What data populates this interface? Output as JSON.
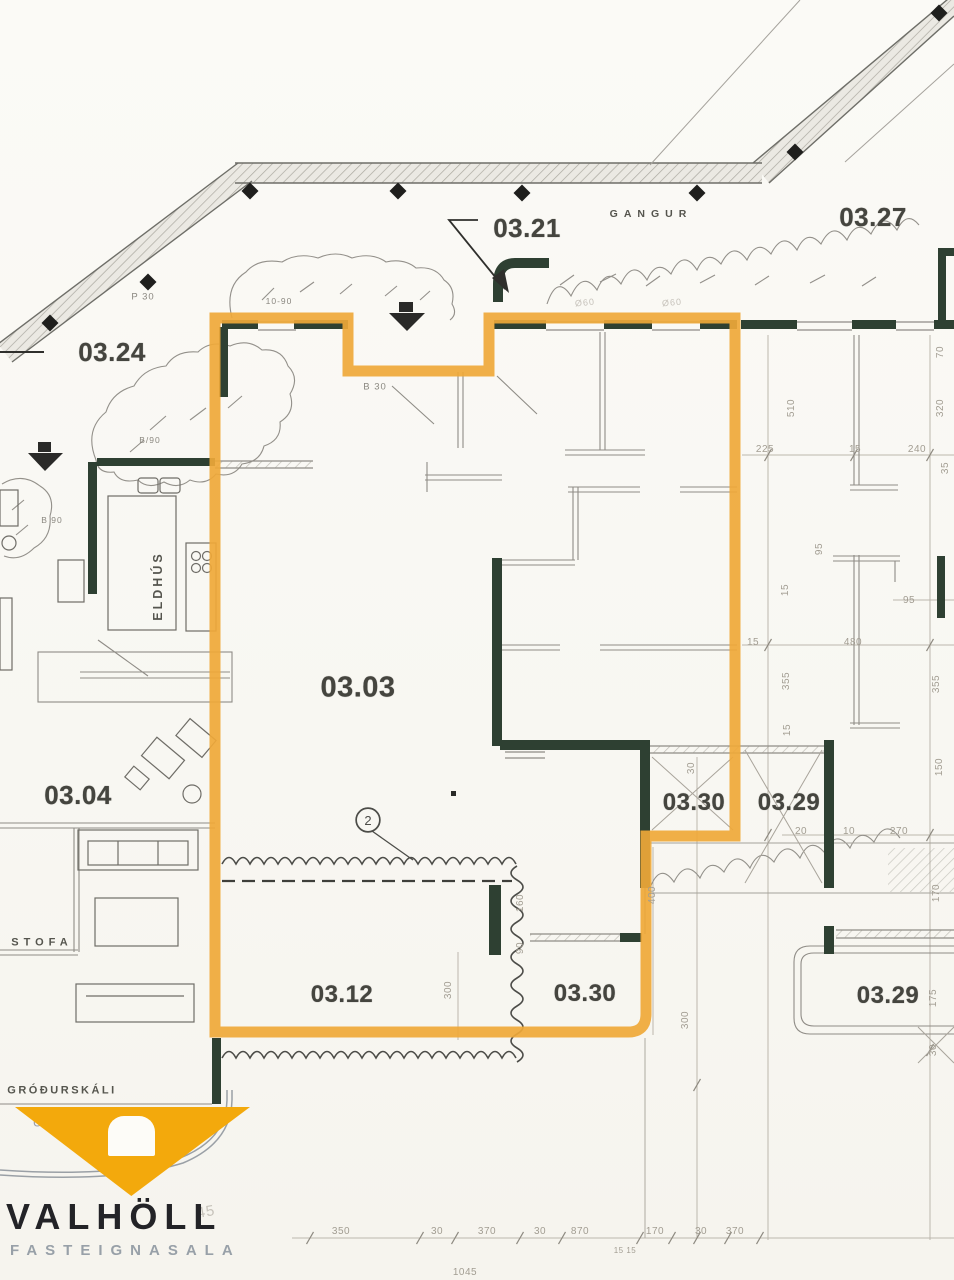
{
  "colors": {
    "paper": "#f9f8f4",
    "highlight_outline": "#efa838",
    "wall_green": "#2e4032",
    "thin_line": "#8f8c86",
    "dim_text": "#a29d92",
    "label_text": "#45453f",
    "logo_yellow": "#f3a90c",
    "logo_text": "#232327",
    "logo_subtext": "#98a0a8"
  },
  "plan": {
    "room_labels": [
      {
        "name": "room-label-03-21",
        "text": "03.21",
        "x": 527,
        "y": 228
      },
      {
        "name": "room-label-03-27",
        "text": "03.27",
        "x": 873,
        "y": 217
      },
      {
        "name": "room-label-03-24",
        "text": "03.24",
        "x": 112,
        "y": 352
      },
      {
        "name": "room-label-03-03",
        "text": "03.03",
        "x": 358,
        "y": 688,
        "size": 29
      },
      {
        "name": "room-label-03-04",
        "text": "03.04",
        "x": 78,
        "y": 795
      },
      {
        "name": "room-label-03-30-mid",
        "text": "03.30",
        "x": 694,
        "y": 803,
        "size": 24
      },
      {
        "name": "room-label-03-29-mid",
        "text": "03.29",
        "x": 789,
        "y": 803,
        "size": 24
      },
      {
        "name": "room-label-03-12",
        "text": "03.12",
        "x": 342,
        "y": 995,
        "size": 24
      },
      {
        "name": "room-label-03-30-bottom",
        "text": "03.30",
        "x": 585,
        "y": 994,
        "size": 24
      },
      {
        "name": "room-label-03-29-bottom",
        "text": "03.29",
        "x": 888,
        "y": 996,
        "size": 24
      }
    ],
    "area_labels": [
      {
        "name": "area-label-gangur",
        "text": "GANGUR",
        "x": 651,
        "y": 214,
        "size": 10.5,
        "ls": 6
      },
      {
        "name": "area-label-stofa",
        "text": "STOFA",
        "x": 42,
        "y": 943,
        "size": 11,
        "ls": 5
      },
      {
        "name": "area-label-eldhus",
        "text": "ELDHÚS",
        "x": 158,
        "y": 586,
        "size": 12.5,
        "ls": 3,
        "rot": -90
      },
      {
        "name": "area-label-grodurskali",
        "text": "GRÓÐURSKÁLI",
        "x": 62,
        "y": 1091,
        "size": 11,
        "ls": 2.5
      }
    ],
    "small_labels": [
      {
        "name": "note-p30",
        "text": "P 30",
        "x": 143,
        "y": 297
      },
      {
        "name": "note-b30",
        "text": "B 30",
        "x": 375,
        "y": 387
      },
      {
        "name": "note-10-90",
        "text": "10-90",
        "x": 279,
        "y": 301,
        "size": 8.5
      },
      {
        "name": "note-b90-upper",
        "text": "B/90",
        "x": 150,
        "y": 440,
        "size": 8.5
      },
      {
        "name": "note-b90-lower",
        "text": "B 90",
        "x": 52,
        "y": 520,
        "size": 8.5
      },
      {
        "name": "note-o60-a",
        "text": "Ø60",
        "x": 585,
        "y": 303,
        "size": 9,
        "rot": -6,
        "cls": "faint2"
      },
      {
        "name": "note-o60-b",
        "text": "Ø60",
        "x": 672,
        "y": 303,
        "size": 9,
        "rot": -5,
        "cls": "faint2"
      },
      {
        "name": "note-u",
        "text": "Ú",
        "x": 38,
        "y": 1122,
        "size": 13,
        "cls": "bluegray"
      },
      {
        "name": "note-scribble-45",
        "text": "45",
        "x": 206,
        "y": 1212,
        "size": 15,
        "rot": -10,
        "cls": "faint2"
      }
    ],
    "dimension_labels": [
      {
        "text": "70",
        "x": 941,
        "y": 352,
        "rot": -90
      },
      {
        "text": "320",
        "x": 941,
        "y": 408,
        "rot": -90
      },
      {
        "text": "510",
        "x": 792,
        "y": 408,
        "rot": -90
      },
      {
        "text": "225",
        "x": 765,
        "y": 450
      },
      {
        "text": "15",
        "x": 855,
        "y": 450
      },
      {
        "text": "240",
        "x": 917,
        "y": 450
      },
      {
        "text": "35",
        "x": 946,
        "y": 468,
        "rot": -90
      },
      {
        "text": "95",
        "x": 820,
        "y": 549,
        "rot": -90
      },
      {
        "text": "15",
        "x": 786,
        "y": 590,
        "rot": -90
      },
      {
        "text": "95",
        "x": 909,
        "y": 601
      },
      {
        "text": "15",
        "x": 753,
        "y": 643
      },
      {
        "text": "480",
        "x": 853,
        "y": 643
      },
      {
        "text": "355",
        "x": 787,
        "y": 681,
        "rot": -90
      },
      {
        "text": "355",
        "x": 937,
        "y": 684,
        "rot": -90
      },
      {
        "text": "15",
        "x": 788,
        "y": 730,
        "rot": -90
      },
      {
        "text": "150",
        "x": 940,
        "y": 767,
        "rot": -90
      },
      {
        "text": "30",
        "x": 692,
        "y": 768,
        "rot": -90
      },
      {
        "text": "20",
        "x": 801,
        "y": 832
      },
      {
        "text": "10",
        "x": 849,
        "y": 832
      },
      {
        "text": "270",
        "x": 899,
        "y": 832
      },
      {
        "text": "400",
        "x": 653,
        "y": 895,
        "rot": -90
      },
      {
        "text": "170",
        "x": 937,
        "y": 893,
        "rot": -90
      },
      {
        "text": "160",
        "x": 521,
        "y": 903,
        "rot": -90
      },
      {
        "text": "90",
        "x": 521,
        "y": 948,
        "rot": -90
      },
      {
        "text": "300",
        "x": 449,
        "y": 990,
        "rot": -90
      },
      {
        "text": "300",
        "x": 686,
        "y": 1020,
        "rot": -90
      },
      {
        "text": "175",
        "x": 934,
        "y": 998,
        "rot": -90
      },
      {
        "text": "30",
        "x": 934,
        "y": 1050,
        "rot": -90
      },
      {
        "text": "350",
        "x": 341,
        "y": 1232
      },
      {
        "text": "30",
        "x": 437,
        "y": 1232
      },
      {
        "text": "370",
        "x": 487,
        "y": 1232
      },
      {
        "text": "30",
        "x": 540,
        "y": 1232
      },
      {
        "text": "870",
        "x": 580,
        "y": 1232
      },
      {
        "text": "170",
        "x": 655,
        "y": 1232
      },
      {
        "text": "30",
        "x": 701,
        "y": 1232
      },
      {
        "text": "370",
        "x": 735,
        "y": 1232
      },
      {
        "text": "15 15",
        "x": 625,
        "y": 1251,
        "size": 8
      },
      {
        "text": "1045",
        "x": 465,
        "y": 1273
      }
    ],
    "markers": [
      {
        "name": "change-marker-2",
        "text": "2",
        "x": 368,
        "y": 820,
        "cls": "marker"
      }
    ]
  },
  "logo": {
    "brand": "VALHÖLL",
    "tagline": "FASTEIGNASALA"
  }
}
